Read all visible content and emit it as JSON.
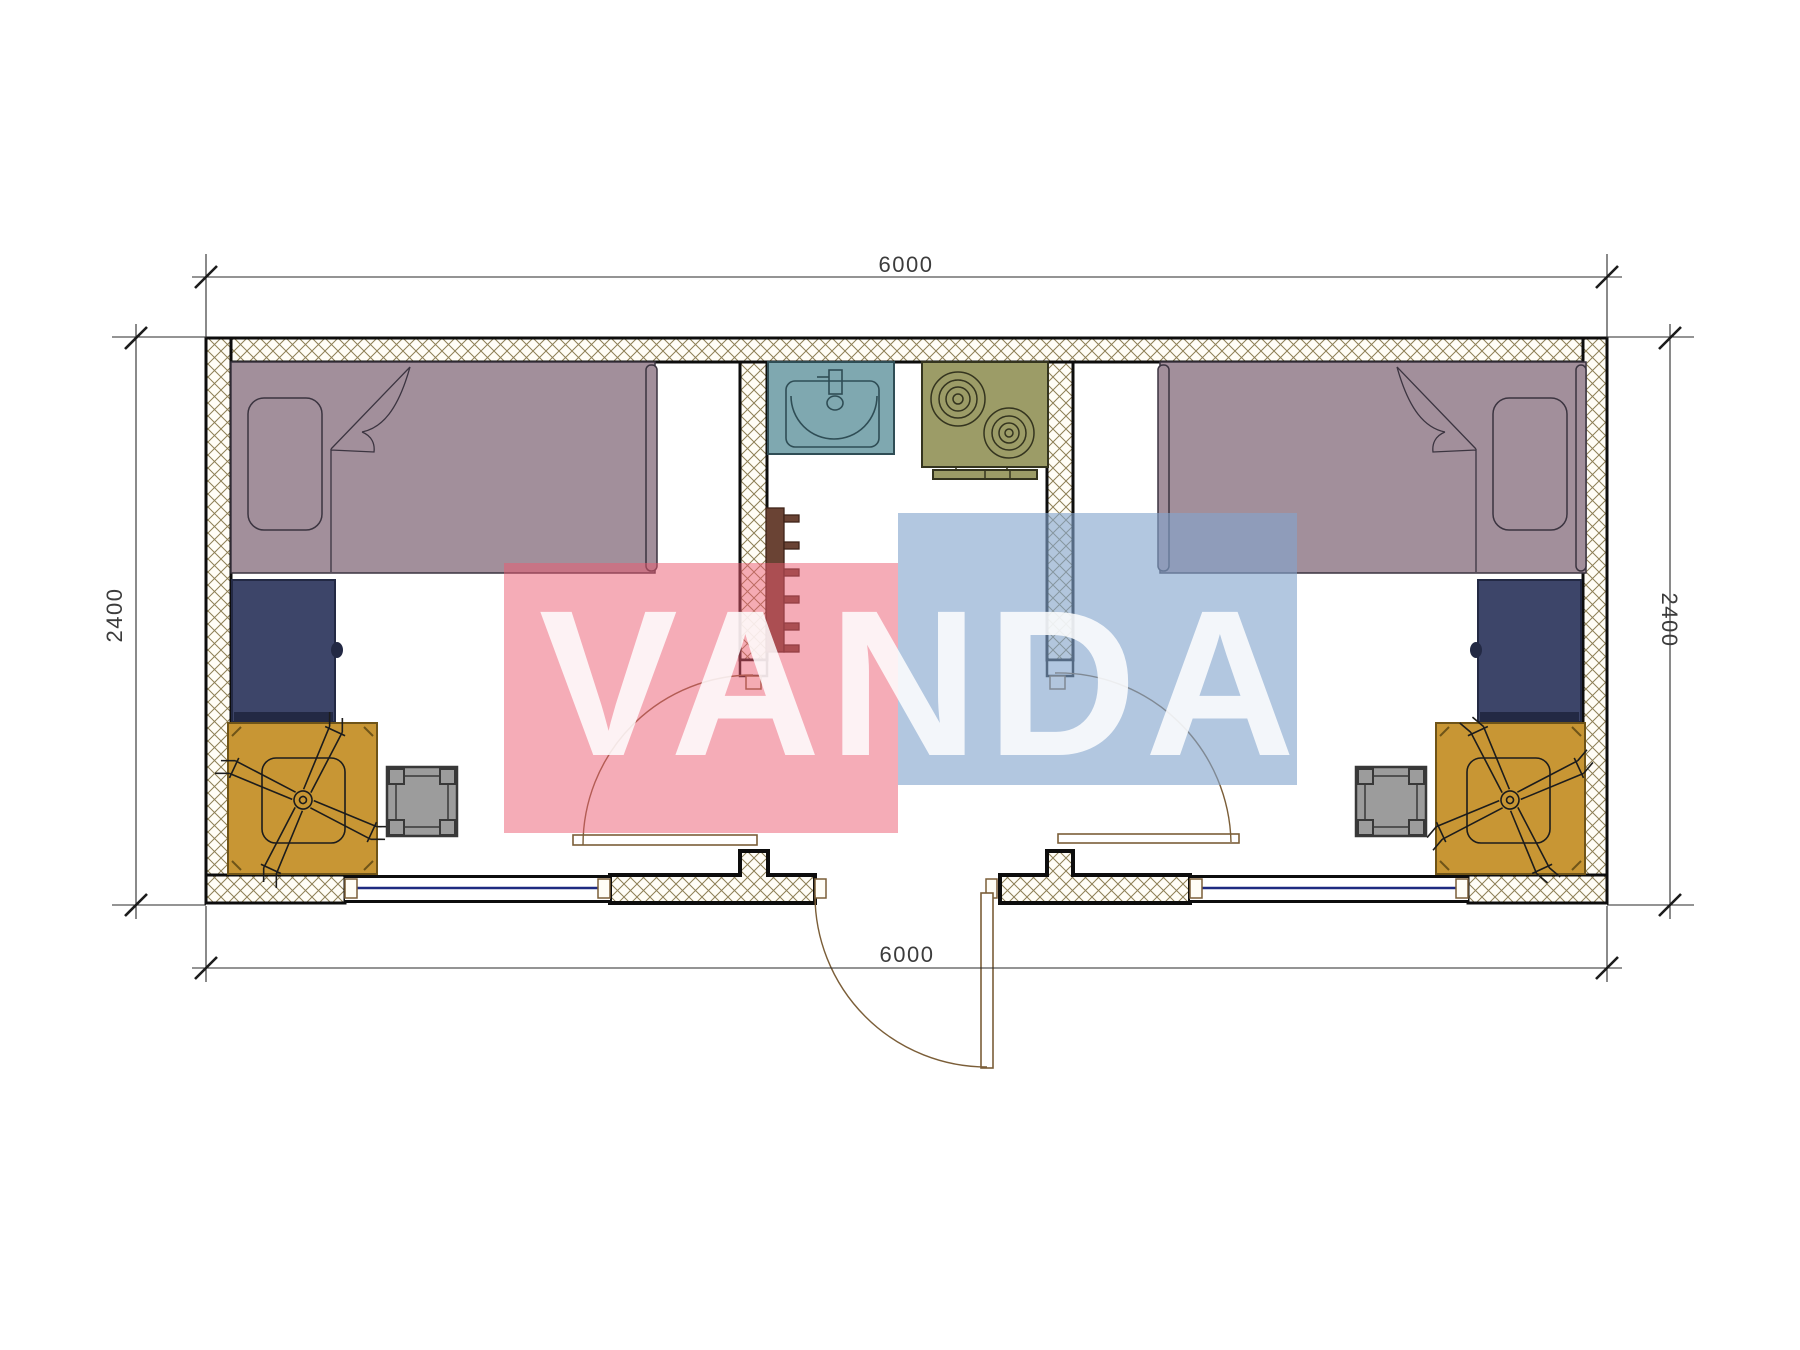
{
  "drawing": {
    "type": "floor-plan",
    "unit_label": "container cabin 6000 x 2400",
    "rooms": [
      "left-bedroom",
      "central-entry-kitchen",
      "right-bedroom"
    ],
    "elements": [
      "bed-left",
      "bed-right",
      "pillow-left",
      "pillow-right",
      "wardrobe-left",
      "wardrobe-right",
      "desk-left",
      "desk-right",
      "office-chair-left",
      "office-chair-right",
      "stool-left",
      "stool-right",
      "sink",
      "stove-2-burner",
      "towel-hook-strip",
      "entry-door",
      "interior-door-left",
      "interior-door-right",
      "window-left",
      "window-right"
    ]
  },
  "dimensions": {
    "top": "6000",
    "bottom": "6000",
    "left": "2400",
    "right": "2400"
  },
  "watermark": {
    "text": "VANDA"
  },
  "colors": {
    "wall-line": "#0d0d0d",
    "hatch-line": "#8d7f55",
    "hatch-bg": "#fffdf6",
    "dim-line": "#2a2a2a",
    "dim-text": "#3c3c3c",
    "bed": "#a28f9b",
    "bed-line": "#3b3440",
    "wardrobe": "#3d4569",
    "wardrobe-line": "#232944",
    "desk": "#c89634",
    "desk-line": "#6f5418",
    "stool": "#9c9c9c",
    "stool-line": "#383838",
    "sink": "#7fa8b0",
    "sink-line": "#2f4d55",
    "stove": "#9c9c67",
    "stove-line": "#34341f",
    "hook": "#6a4334",
    "hook-line": "#3f2318",
    "door-line": "#7b5e38",
    "window-glass": "#1e2a80",
    "wm-pink": "#ec5a70",
    "wm-blue": "#82a5cd",
    "wm-letters": "#ffffff"
  }
}
